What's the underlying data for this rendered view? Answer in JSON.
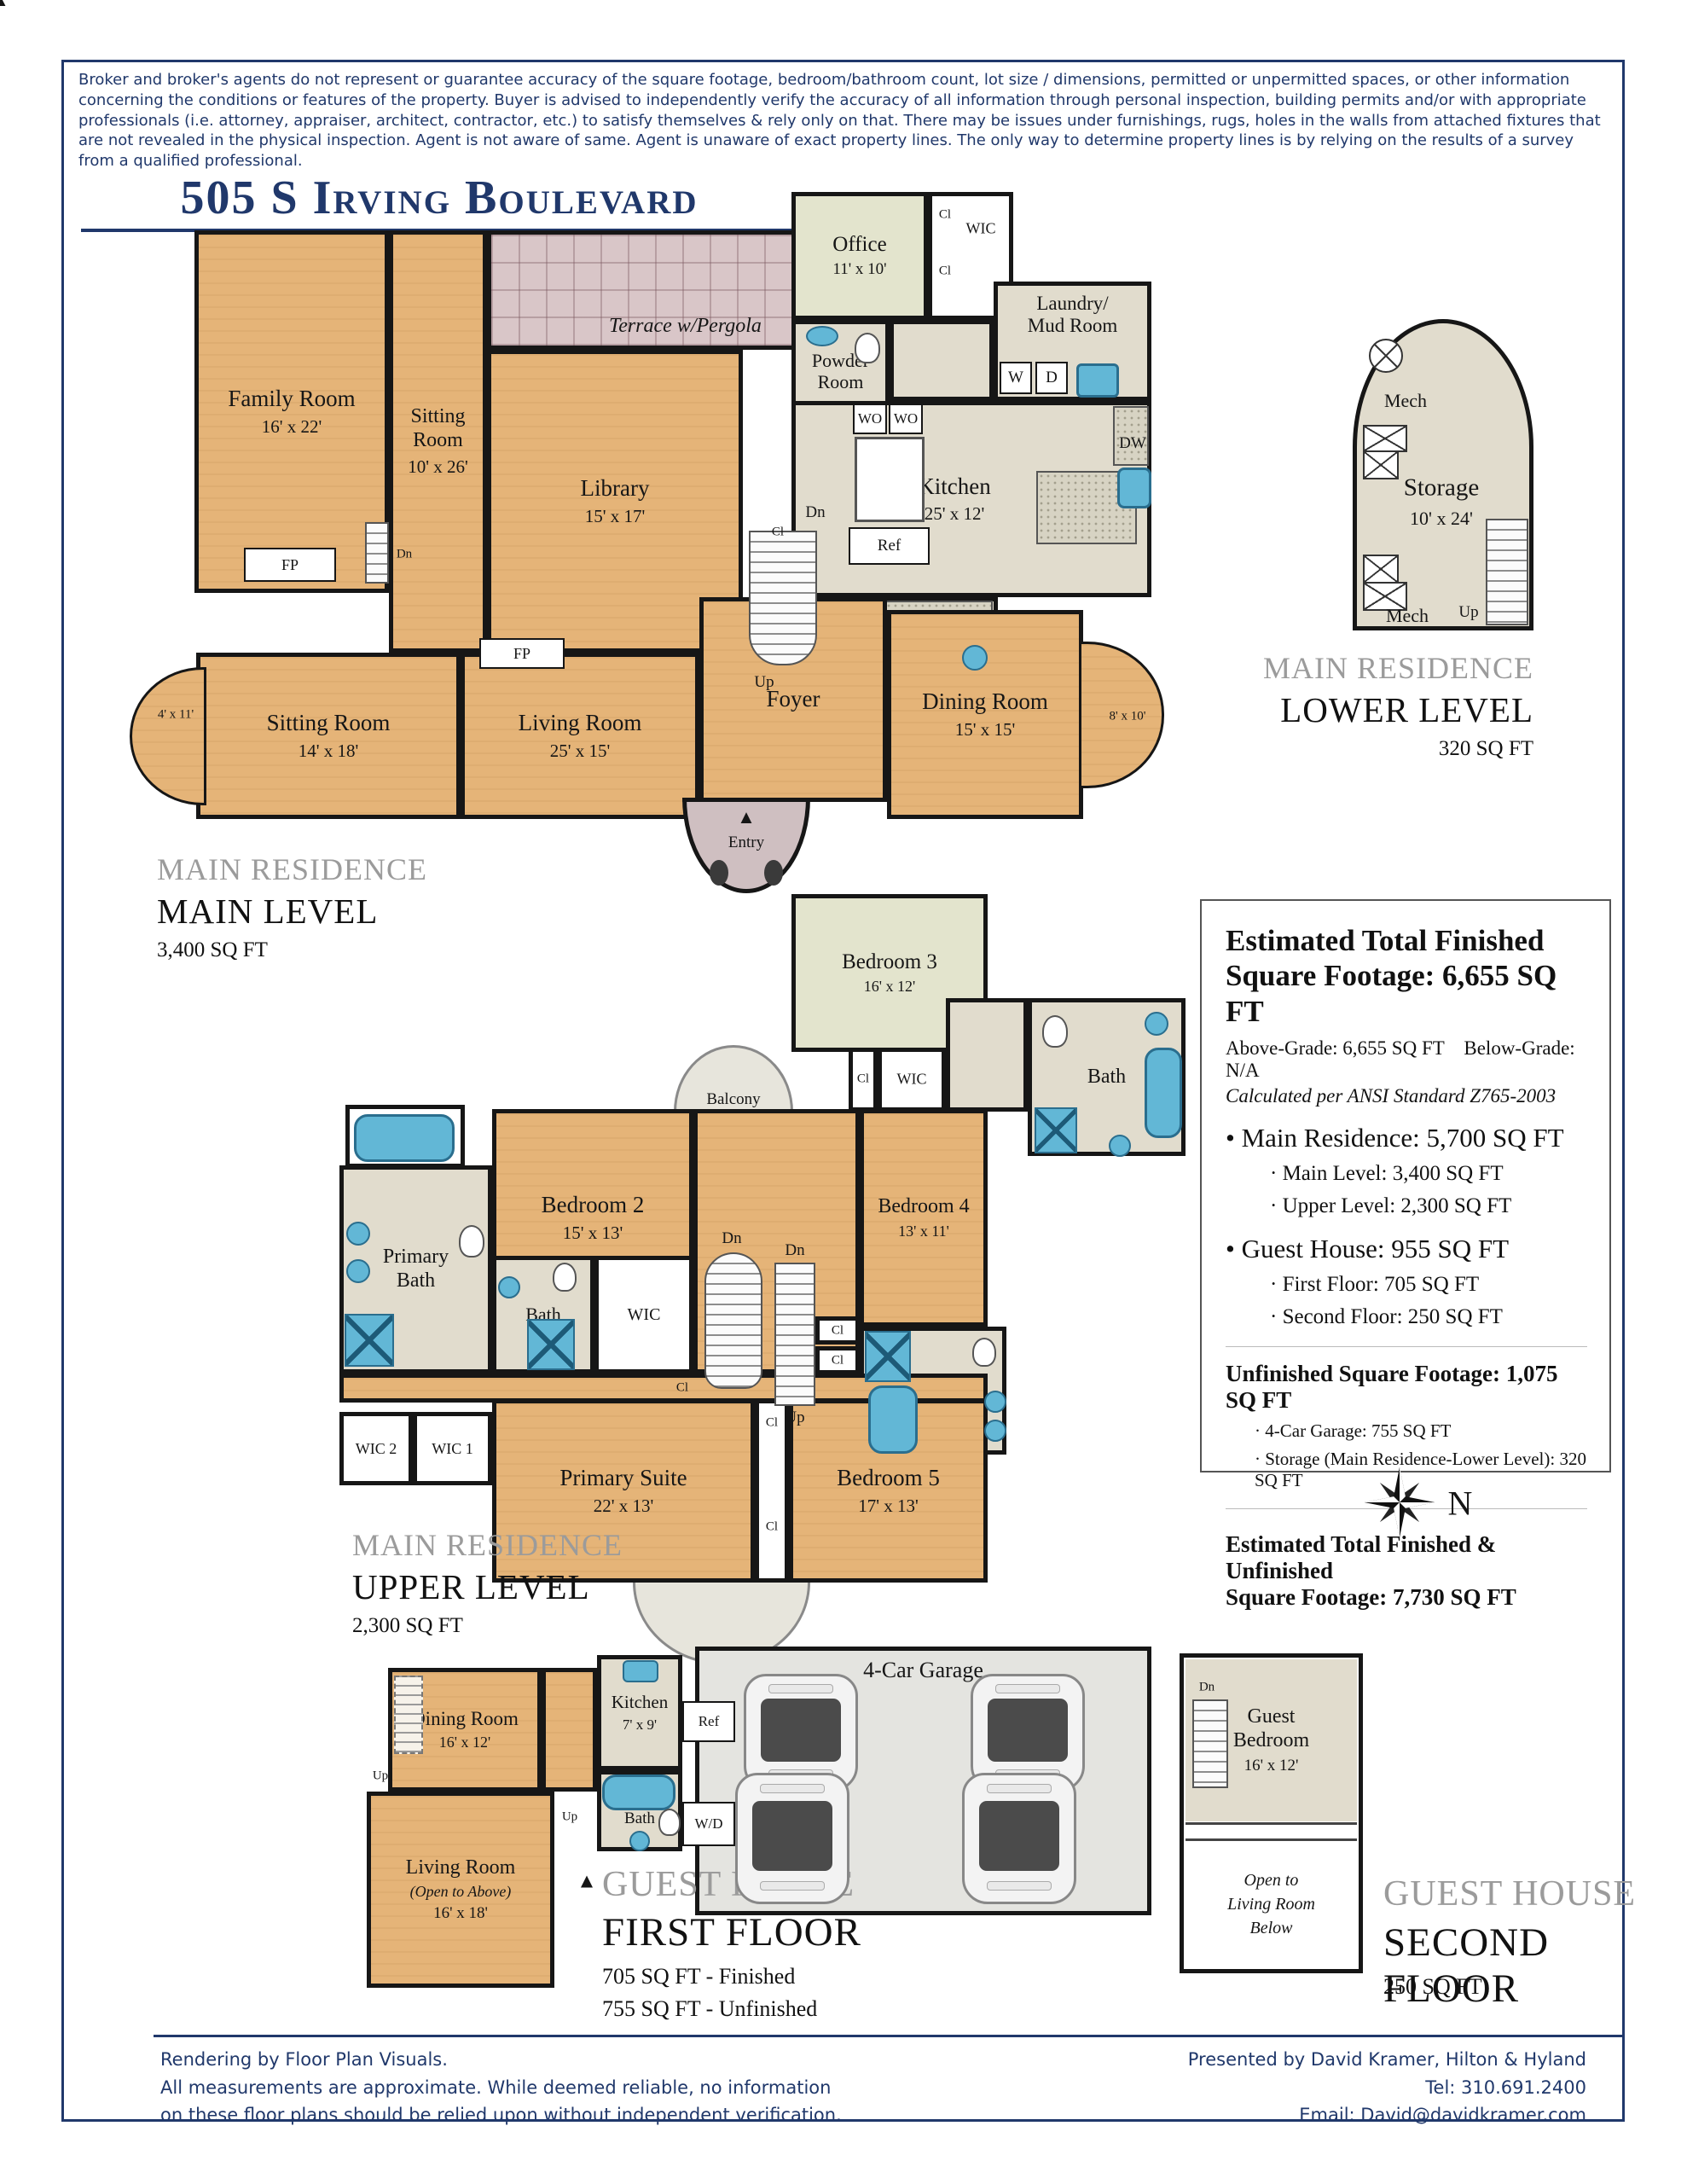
{
  "page": {
    "disclaimer": "Broker and broker's agents do not represent or guarantee accuracy of the square footage, bedroom/bathroom count, lot size / dimensions, permitted or unpermitted spaces, or other information concerning the conditions or features of the property. Buyer is advised to independently verify the accuracy of all information through personal inspection, building permits and/or with appropriate professionals (i.e. attorney, appraiser, architect, contractor, etc.) to satisfy themselves & rely only on that. There may be issues under furnishings, rugs, holes in the walls from attached fixtures that are not revealed in the physical inspection. Agent is not aware of same. Agent is unaware of exact property lines. The only way to determine property lines is by relying on the results of a survey from a qualified professional.",
    "title": "505 S Irving Boulevard",
    "subtitle": "Los Angeles, CA 90020",
    "colors": {
      "navy": "#20386b",
      "wood": "#e5b478",
      "tile": "#e1dccd",
      "green": "#e3e4cd",
      "mauve": "#d9c6c8",
      "garage": "#e4e4e0",
      "fixture": "#62b7d6",
      "heading_gray": "#9b9b9b"
    }
  },
  "markers": {
    "fp": "FP",
    "dn": "Dn",
    "up": "Up",
    "cl": "Cl",
    "wic": "WIC",
    "ref": "Ref",
    "wo": "WO",
    "w": "W",
    "d": "D",
    "dw": "DW",
    "wd": "W/D",
    "mech": "Mech",
    "bath": "Bath",
    "entry": "Entry",
    "north": "N",
    "entry_arrow": "▲"
  },
  "main_level": {
    "heading_residence": "MAIN RESIDENCE",
    "heading_level": "MAIN LEVEL",
    "heading_sqft": "3,400 SQ FT",
    "family_room": {
      "name": "Family Room",
      "dims": "16' x 22'"
    },
    "sitting_room_10": {
      "name": "Sitting\nRoom",
      "dims": "10' x 26'"
    },
    "terrace": {
      "name": "Terrace w/Pergola"
    },
    "library": {
      "name": "Library",
      "dims": "15' x 17'"
    },
    "breakfast": {
      "name": "Breakfast\nRoom",
      "dims": "10' x 12'"
    },
    "office": {
      "name": "Office",
      "dims": "11' x 10'"
    },
    "powder": {
      "name": "Powder\nRoom"
    },
    "laundry": {
      "name": "Laundry/\nMud Room"
    },
    "kitchen": {
      "name": "Kitchen",
      "dims": "25' x 12'"
    },
    "butlers": {
      "name": "Butler's\nPantry"
    },
    "foyer": {
      "name": "Foyer"
    },
    "living": {
      "name": "Living Room",
      "dims": "25' x 15'"
    },
    "sitting_room_14": {
      "name": "Sitting Room",
      "dims": "14' x 18'"
    },
    "dining": {
      "name": "Dining Room",
      "dims": "15' x 15'"
    },
    "bay_left": "4' x 11'",
    "bay_right": "8' x 10'"
  },
  "lower_level": {
    "heading_residence": "MAIN RESIDENCE",
    "heading_level": "LOWER LEVEL",
    "heading_sqft": "320 SQ FT",
    "storage": {
      "name": "Storage",
      "dims": "10' x 24'"
    }
  },
  "upper_level": {
    "heading_residence": "MAIN RESIDENCE",
    "heading_level": "UPPER LEVEL",
    "heading_sqft": "2,300 SQ FT",
    "bedroom2": {
      "name": "Bedroom 2",
      "dims": "15' x 13'"
    },
    "bedroom3": {
      "name": "Bedroom 3",
      "dims": "16' x 12'"
    },
    "bedroom4": {
      "name": "Bedroom 4",
      "dims": "13' x 11'"
    },
    "bedroom5": {
      "name": "Bedroom 5",
      "dims": "17' x 13'"
    },
    "primary_suite": {
      "name": "Primary Suite",
      "dims": "22' x 13'"
    },
    "primary_bath": {
      "name": "Primary\nBath"
    },
    "balcony": "Balcony",
    "wic1": "WIC 1",
    "wic2": "WIC 2"
  },
  "summary": {
    "title": "Estimated Total Finished\nSquare Footage: 6,655 SQ FT",
    "grade": "Above-Grade: 6,655 SQ FT    Below-Grade: N/A",
    "ansi": "Calculated per ANSI Standard Z765-2003",
    "main_residence": "• Main Residence: 5,700 SQ FT",
    "main_level_sf": "·  Main Level: 3,400 SQ FT",
    "upper_level_sf": "·  Upper Level: 2,300 SQ FT",
    "guest_house": "• Guest House: 955 SQ FT",
    "first_floor_sf": "·  First Floor: 705 SQ FT",
    "second_floor_sf": "·  Second Floor: 250 SQ FT",
    "unfinished": "Unfinished Square Footage: 1,075 SQ FT",
    "garage_sf": "·  4-Car Garage: 755 SQ FT",
    "storage_sf": "·  Storage (Main Residence-Lower Level): 320 SQ FT",
    "total": "Estimated Total Finished & Unfinished\nSquare Footage: 7,730 SQ FT"
  },
  "guest_first": {
    "heading_house": "GUEST HOUSE",
    "heading_floor": "FIRST FLOOR",
    "sqft_finished": "705 SQ FT - Finished",
    "sqft_unfinished": "755 SQ FT - Unfinished",
    "dining": {
      "name": "Dining Room",
      "dims": "16' x 12'"
    },
    "kitchen": {
      "name": "Kitchen",
      "dims": "7' x 9'"
    },
    "living": {
      "name": "Living Room",
      "note": "(Open to Above)",
      "dims": "16' x 18'"
    },
    "garage": "4-Car Garage"
  },
  "guest_second": {
    "heading_house": "GUEST HOUSE",
    "heading_floor": "SECOND FLOOR",
    "heading_sqft": "250 SQ FT",
    "bedroom": {
      "name": "Guest\nBedroom",
      "dims": "16' x 12'"
    },
    "open_note": "Open to\nLiving Room\nBelow"
  },
  "footer": {
    "left": "Rendering by Floor Plan Visuals.\nAll measurements are approximate. While deemed reliable, no information\non these floor plans should be relied upon without independent verification.",
    "right": "Presented by David Kramer, Hilton & Hyland\nTel: 310.691.2400\nEmail: David@davidkramer.com"
  }
}
